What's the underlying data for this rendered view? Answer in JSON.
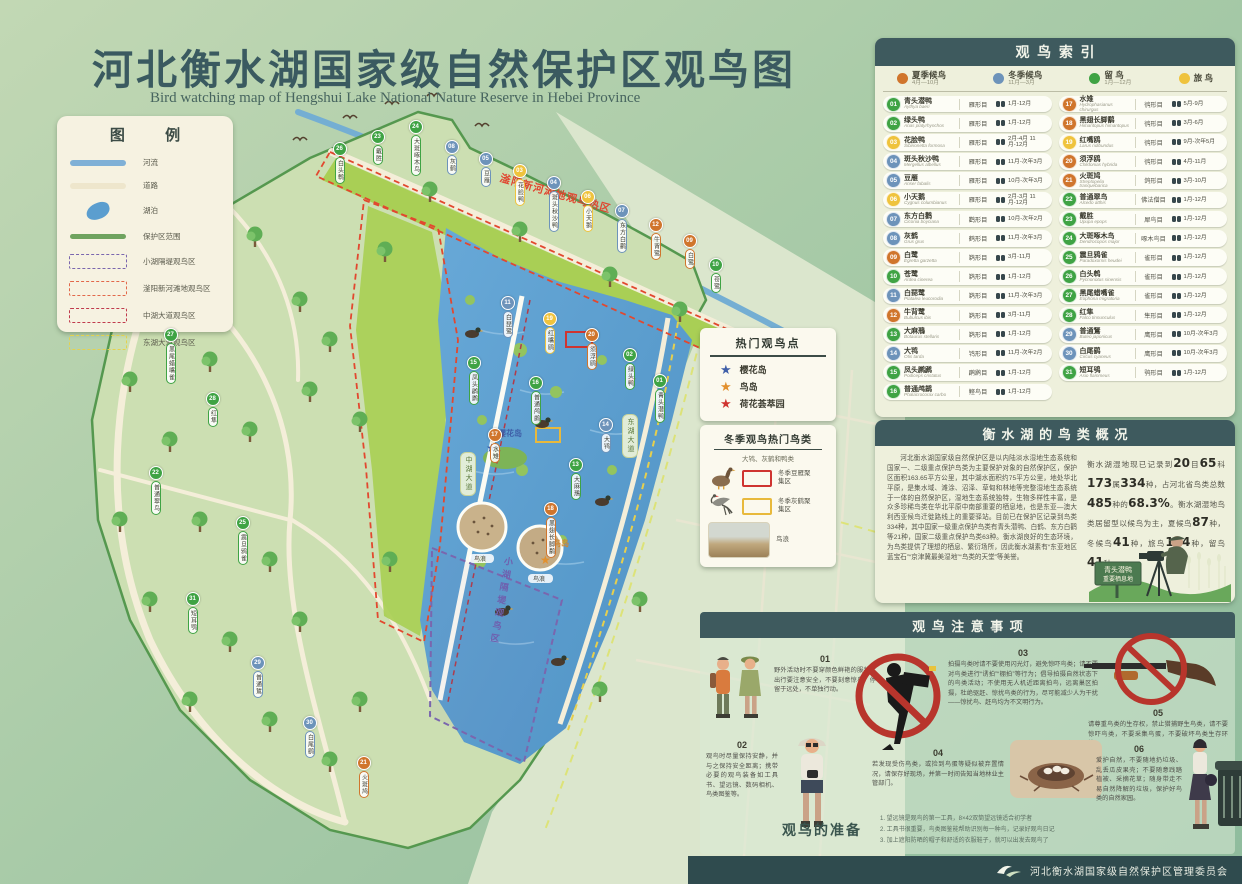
{
  "title": {
    "cn": "河北衡水湖国家级自然保护区观鸟图",
    "en": "Bird watching map of Hengshui Lake National Nature Reserve in Hebei Province"
  },
  "legend": {
    "title": "图 例",
    "items": [
      {
        "label": "河流"
      },
      {
        "label": "道路"
      },
      {
        "label": "湖泊"
      },
      {
        "label": "保护区范围"
      },
      {
        "label": "小湖隔堤观鸟区"
      },
      {
        "label": "滏阳新河滩地观鸟区"
      },
      {
        "label": "中湖大道观鸟区"
      },
      {
        "label": "东湖大道观鸟区"
      }
    ]
  },
  "index": {
    "title": "观鸟索引",
    "seasons": [
      {
        "id": "summer",
        "label": "夏季候鸟",
        "range": "4月—10月",
        "color": "#d0752c"
      },
      {
        "id": "winter",
        "label": "冬季候鸟",
        "range": "11月—3月",
        "color": "#6d93ba"
      },
      {
        "id": "resident",
        "label": "留  鸟",
        "range": "1月—12月",
        "color": "#3fa344"
      },
      {
        "id": "passage",
        "label": "旅  鸟",
        "range": "",
        "color": "#efc33d"
      }
    ],
    "birds": [
      {
        "num": "01",
        "name": "青头潜鸭",
        "latin": "Aythya baeri",
        "order": "雁形目",
        "months": "1月-12月",
        "season": "resident"
      },
      {
        "num": "02",
        "name": "绿头鸭",
        "latin": "Anas platyrhynchos",
        "order": "雁形目",
        "months": "1月-12月",
        "season": "resident"
      },
      {
        "num": "03",
        "name": "花脸鸭",
        "latin": "Sibirionetta formosa",
        "order": "雁形目",
        "months": "2月-4月 11月-12月",
        "season": "passage"
      },
      {
        "num": "04",
        "name": "斑头秋沙鸭",
        "latin": "Mergellus albellus",
        "order": "雁形目",
        "months": "11月-次年3月",
        "season": "winter"
      },
      {
        "num": "05",
        "name": "豆雁",
        "latin": "Anser fabalis",
        "order": "雁形目",
        "months": "10月-次年3月",
        "season": "winter"
      },
      {
        "num": "06",
        "name": "小天鹅",
        "latin": "Cygnus columbianus",
        "order": "雁形目",
        "months": "2月-3月 11月-12月",
        "season": "passage"
      },
      {
        "num": "07",
        "name": "东方白鹳",
        "latin": "Ciconia boyciana",
        "order": "鹳形目",
        "months": "10月-次年2月",
        "season": "winter"
      },
      {
        "num": "08",
        "name": "灰鹤",
        "latin": "Grus grus",
        "order": "鹤形目",
        "months": "11月-次年3月",
        "season": "winter"
      },
      {
        "num": "09",
        "name": "白鹭",
        "latin": "Egretta garzetta",
        "order": "鹈形目",
        "months": "3月-11月",
        "season": "summer"
      },
      {
        "num": "10",
        "name": "苍鹭",
        "latin": "Ardea cinerea",
        "order": "鹈形目",
        "months": "1月-12月",
        "season": "resident"
      },
      {
        "num": "11",
        "name": "白琵鹭",
        "latin": "Platalea leucorodia",
        "order": "鹈形目",
        "months": "11月-次年3月",
        "season": "winter"
      },
      {
        "num": "12",
        "name": "牛背鹭",
        "latin": "Bubulcus ibis",
        "order": "鹈形目",
        "months": "3月-11月",
        "season": "summer"
      },
      {
        "num": "13",
        "name": "大麻鳽",
        "latin": "Botaurus stellaris",
        "order": "鹈形目",
        "months": "1月-12月",
        "season": "resident"
      },
      {
        "num": "14",
        "name": "大鸨",
        "latin": "Otis tarda",
        "order": "鸨形目",
        "months": "11月-次年2月",
        "season": "winter"
      },
      {
        "num": "15",
        "name": "凤头䴙䴘",
        "latin": "Podiceps cristatus",
        "order": "䴙䴘目",
        "months": "1月-12月",
        "season": "resident"
      },
      {
        "num": "16",
        "name": "普通鸬鹚",
        "latin": "Phalacrocorax carbo",
        "order": "鲣鸟目",
        "months": "1月-12月",
        "season": "resident"
      },
      {
        "num": "17",
        "name": "水雉",
        "latin": "Hydrophasianus chirurgus",
        "order": "鸻形目",
        "months": "5月-9月",
        "season": "summer"
      },
      {
        "num": "18",
        "name": "黑翅长脚鹬",
        "latin": "Himantopus himantopus",
        "order": "鸻形目",
        "months": "3月-6月",
        "season": "summer"
      },
      {
        "num": "19",
        "name": "红嘴鸥",
        "latin": "Larus ridibundus",
        "order": "鸻形目",
        "months": "9月-次年5月",
        "season": "passage"
      },
      {
        "num": "20",
        "name": "须浮鸥",
        "latin": "Chlidonias hybrida",
        "order": "鸻形目",
        "months": "4月-11月",
        "season": "summer"
      },
      {
        "num": "21",
        "name": "火斑鸠",
        "latin": "Streptopelia tranquebarica",
        "order": "鸽形目",
        "months": "3月-10月",
        "season": "summer"
      },
      {
        "num": "22",
        "name": "普通翠鸟",
        "latin": "Alcedo atthis",
        "order": "佛法僧目",
        "months": "1月-12月",
        "season": "resident"
      },
      {
        "num": "23",
        "name": "戴胜",
        "latin": "Upupa epops",
        "order": "犀鸟目",
        "months": "1月-12月",
        "season": "resident"
      },
      {
        "num": "24",
        "name": "大斑啄木鸟",
        "latin": "Dendrocopos major",
        "order": "啄木鸟目",
        "months": "1月-12月",
        "season": "resident"
      },
      {
        "num": "25",
        "name": "震旦鸦雀",
        "latin": "Paradoxornis heudei",
        "order": "雀形目",
        "months": "1月-12月",
        "season": "resident"
      },
      {
        "num": "26",
        "name": "白头鹎",
        "latin": "Pycnonotus sinensis",
        "order": "雀形目",
        "months": "1月-12月",
        "season": "resident"
      },
      {
        "num": "27",
        "name": "黑尾蜡嘴雀",
        "latin": "Eophona migratoria",
        "order": "雀形目",
        "months": "1月-12月",
        "season": "resident"
      },
      {
        "num": "28",
        "name": "红隼",
        "latin": "Falco tinnunculus",
        "order": "隼形目",
        "months": "1月-12月",
        "season": "resident"
      },
      {
        "num": "29",
        "name": "普通鵟",
        "latin": "Buteo japonicus",
        "order": "鹰形目",
        "months": "10月-次年3月",
        "season": "winter"
      },
      {
        "num": "30",
        "name": "白尾鹞",
        "latin": "Circus cyaneus",
        "order": "鹰形目",
        "months": "10月-次年3月",
        "season": "winter"
      },
      {
        "num": "31",
        "name": "短耳鸮",
        "latin": "Asio flammeus",
        "order": "鸮形目",
        "months": "1月-12月",
        "season": "resident"
      }
    ]
  },
  "hotspots": {
    "title": "热门观鸟点",
    "items": [
      {
        "label": "樱花岛",
        "color": "#3f5fa8"
      },
      {
        "label": "鸟岛",
        "color": "#e2902e"
      },
      {
        "label": "荷花荟萃园",
        "color": "#cf3430"
      }
    ]
  },
  "winter": {
    "title": "冬季观鸟热门鸟类",
    "subtitle": "大鸨、灰鹤和鸭类",
    "zones": [
      {
        "label": "冬季豆雁聚集区",
        "color": "#cf3430"
      },
      {
        "label": "冬季灰鹤聚集区",
        "color": "#e8b93c"
      }
    ],
    "photo_label": "鸟浪"
  },
  "overview": {
    "title": "衡水湖的鸟类概况",
    "intro": "河北衡水湖国家级自然保护区是以内陆淡水湿地生态系统和国家一、二级重点保护鸟类为主要保护对象的自然保护区，保护区面积163.65平方公里，其中湖水面积约75平方公里，地处华北平原，是集水域、滩涂、沼泽、草甸和林地等完整湿地生态系统于一体的自然保护区，湿地生态系统独特，生物多样性丰富，是众多珍稀鸟类在华北平原中南部重要的栖息地，也是东亚—澳大利西亚候鸟迁徙路线上的重要驿站。目前已在保护区记录到鸟类334种，其中国家一级重点保护鸟类有青头潜鸭、白鹤、东方白鹳等21种，国家二级重点保护鸟类63种。衡水湖良好的生态环境，为鸟类提供了理想的栖息、繁衍场所，因此衡水湖素有“东亚地区蓝宝石”“京津冀最美湿地”“鸟类的天堂”等美誉。",
    "stats": [
      {
        "t": "衡水湖湿地现已记录到"
      },
      {
        "t": "20",
        "b": 1
      },
      {
        "t": "目"
      },
      {
        "t": "65",
        "b": 1
      },
      {
        "t": "科"
      },
      {
        "t": "173",
        "b": 1
      },
      {
        "t": "属"
      },
      {
        "t": "334",
        "b": 1
      },
      {
        "t": "种，占河北省鸟类总数"
      },
      {
        "t": "485",
        "b": 1
      },
      {
        "t": "种的"
      },
      {
        "t": "68.3%",
        "b": 1
      },
      {
        "t": "。衡水湖湿地鸟类居留型以候鸟为主，夏候鸟"
      },
      {
        "t": "87",
        "b": 1
      },
      {
        "t": "种，冬候鸟"
      },
      {
        "t": "41",
        "b": 1
      },
      {
        "t": "种，旅鸟"
      },
      {
        "t": "164",
        "b": 1
      },
      {
        "t": "种，留鸟"
      },
      {
        "t": "41",
        "b": 1
      },
      {
        "t": "种。"
      }
    ],
    "sign_line1": "青头潜鸭",
    "sign_line2": "重要栖息地"
  },
  "notes": {
    "title": "观鸟注意事项",
    "items": [
      {
        "num": "01",
        "text": "野外活动时不要穿颜色鲜艳的服装，出行要注意安全，不要刻意惊鸟，停留于远处，不单独行动。"
      },
      {
        "num": "02",
        "text": "观鸟时尽量保持安静，并与之保持安全距离；携带必要的观鸟装备如工具书、望远镜、数码相机、鸟类图鉴等。"
      },
      {
        "num": "03",
        "text": "拍摄鸟类时请不要使用闪光灯，避免惊吓鸟类；请不要对鸟类进行“诱拍”“棚拍”等行为；倡导拍摄自然状态下的鸟类活动；不使用无人机近距离拍鸟，远离巢区拍摄，杜绝驱赶、惊扰鸟类的行为，尽可能减少人为干扰——惊扰鸟、赶鸟均为不文明行为。"
      },
      {
        "num": "04",
        "text": "若发现受伤鸟类，或捡到鸟蛋等疑似被弃置情况，请保存好现场，并第一时间告知当地林业主管部门。"
      },
      {
        "num": "05",
        "text": "请尊重鸟类的生存权，禁止猎捕野生鸟类，请不要惊吓鸟类，不要采集鸟蛋，不要破坏鸟类生存环境。"
      },
      {
        "num": "06",
        "text": "爱护自然，不要随地扔垃圾、乱丢瓜皮果壳；不要随意践踏植被、采摘花草；随身带走不易自然降解的垃圾，保护好鸟类的自然家园。"
      }
    ]
  },
  "prep": {
    "title": "观鸟的准备",
    "lines": [
      "1. 望远镜是观鸟的第一工具，8×42双筒望远镜适合初学者",
      "2. 工具书很重要，鸟类图鉴能帮助识别每一种鸟，记录好观鸟日记",
      "3. 加上遮阳防晒的帽子和舒适的衣服鞋子，就可以出发去观鸟了"
    ]
  },
  "footer": {
    "org": "河北衡水湖国家级自然保护区管理委员会"
  },
  "map": {
    "hot_zone_label": "滏阳新河滩地观鸟热区",
    "dike_label": "小湖隔堤观鸟区",
    "island1_label": "樱花岛",
    "island2_label": "鸟岛",
    "road_mid_label": "中湖大道",
    "road_east_label": "东湖大道",
    "wave_label": "鸟浪",
    "tags": [
      {
        "n": "26",
        "x": 332,
        "y": 142
      },
      {
        "n": "23",
        "x": 370,
        "y": 130
      },
      {
        "n": "24",
        "x": 408,
        "y": 120
      },
      {
        "n": "08",
        "x": 444,
        "y": 140
      },
      {
        "n": "05",
        "x": 478,
        "y": 152
      },
      {
        "n": "03",
        "x": 512,
        "y": 164
      },
      {
        "n": "04",
        "x": 546,
        "y": 176
      },
      {
        "n": "06",
        "x": 580,
        "y": 190
      },
      {
        "n": "07",
        "x": 614,
        "y": 204
      },
      {
        "n": "12",
        "x": 648,
        "y": 218
      },
      {
        "n": "09",
        "x": 682,
        "y": 234
      },
      {
        "n": "10",
        "x": 708,
        "y": 258
      },
      {
        "n": "11",
        "x": 500,
        "y": 296
      },
      {
        "n": "19",
        "x": 542,
        "y": 312
      },
      {
        "n": "20",
        "x": 584,
        "y": 328
      },
      {
        "n": "02",
        "x": 622,
        "y": 348
      },
      {
        "n": "01",
        "x": 652,
        "y": 374
      },
      {
        "n": "15",
        "x": 466,
        "y": 356
      },
      {
        "n": "16",
        "x": 528,
        "y": 376
      },
      {
        "n": "14",
        "x": 598,
        "y": 418
      },
      {
        "n": "13",
        "x": 568,
        "y": 458
      },
      {
        "n": "17",
        "x": 487,
        "y": 428
      },
      {
        "n": "18",
        "x": 543,
        "y": 502
      },
      {
        "n": "21",
        "x": 356,
        "y": 756
      },
      {
        "n": "27",
        "x": 163,
        "y": 328
      },
      {
        "n": "28",
        "x": 205,
        "y": 392
      },
      {
        "n": "22",
        "x": 148,
        "y": 466
      },
      {
        "n": "25",
        "x": 235,
        "y": 516
      },
      {
        "n": "31",
        "x": 185,
        "y": 592
      },
      {
        "n": "29",
        "x": 250,
        "y": 656
      },
      {
        "n": "30",
        "x": 302,
        "y": 716
      }
    ]
  }
}
